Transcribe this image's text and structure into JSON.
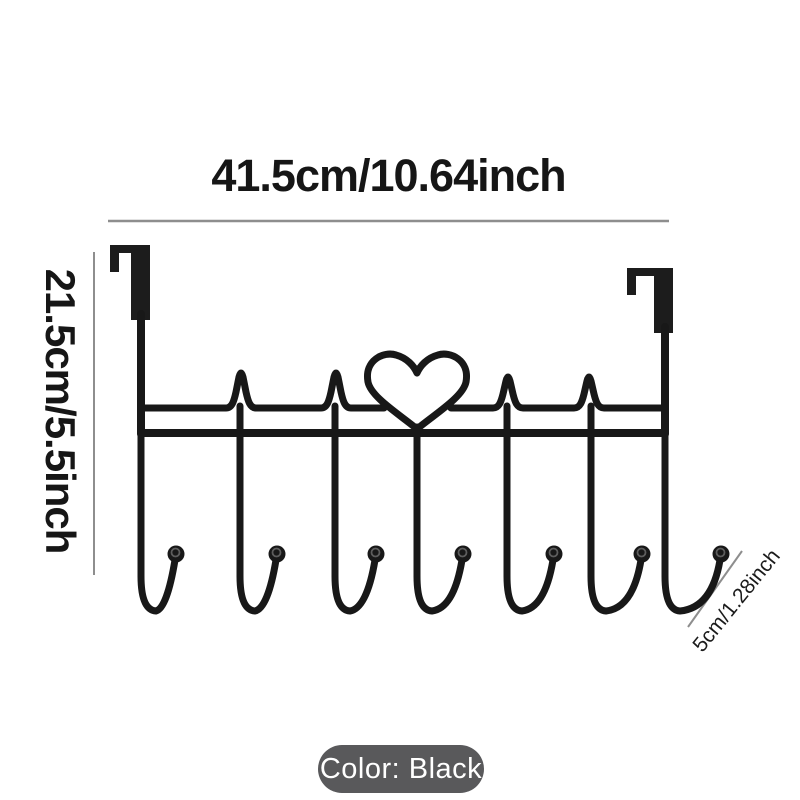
{
  "page": {
    "background": "#ffffff",
    "item_depicted": "over-door heartbeat heart hook rack"
  },
  "product_diagram": {
    "hook_count": 7,
    "labels": {
      "width": "41.5cm/10.64inch",
      "height": "21.5cm/5.5inch",
      "hook_depth": "5cm/1.28inch",
      "color": "Color: Black"
    },
    "colors": {
      "rack": "#181818",
      "dimension_line": "#8e8e8e",
      "label_text": "#161616",
      "color_pill_bg": "#59595b",
      "color_pill_text": "#ffffff"
    }
  }
}
